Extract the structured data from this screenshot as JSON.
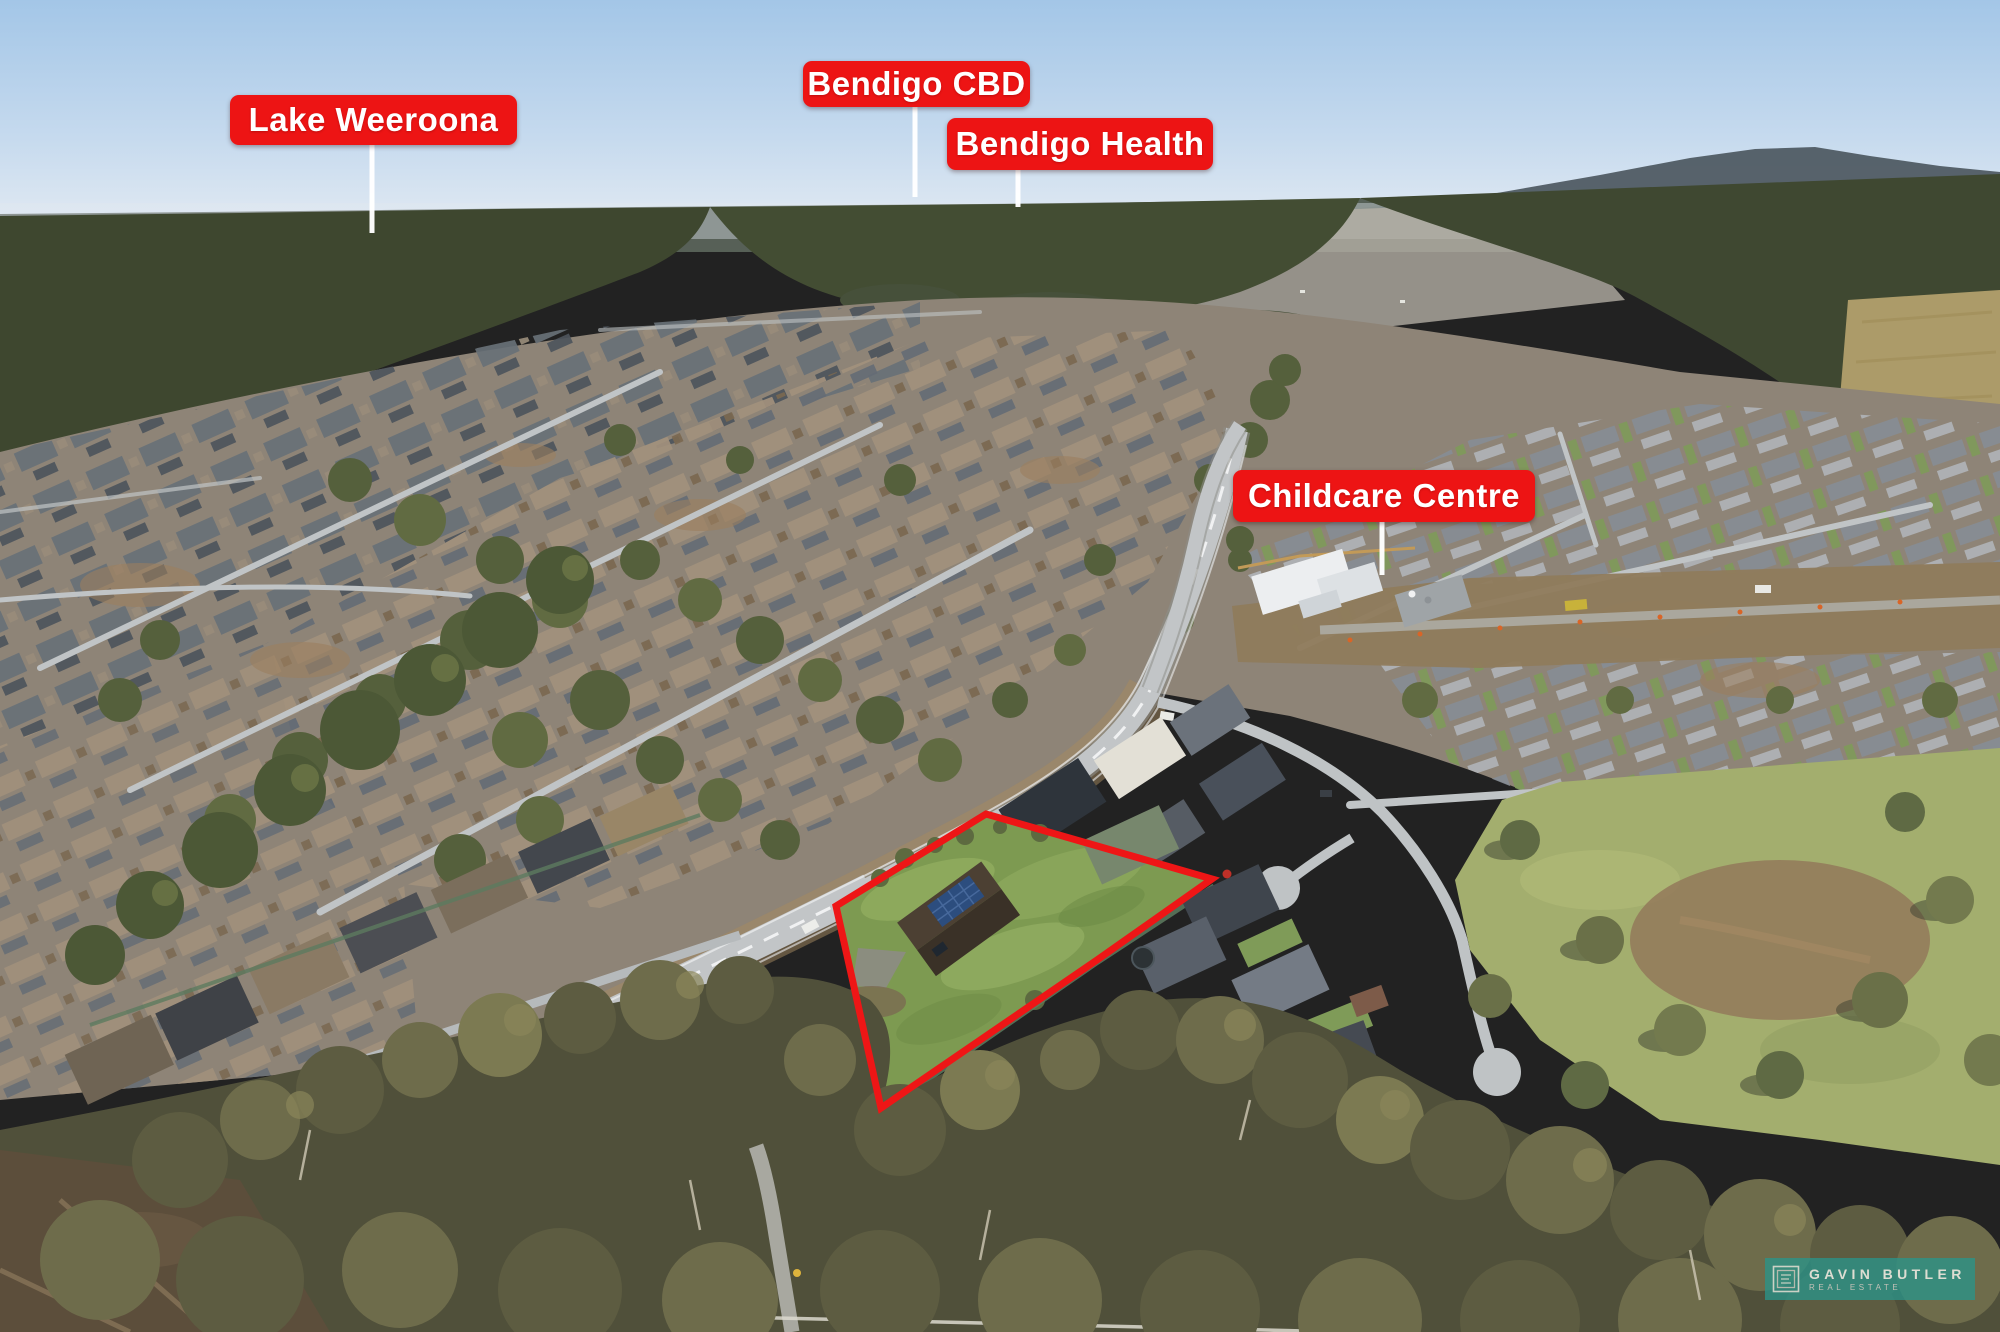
{
  "overlay": {
    "label_bg": "#ed1414",
    "label_fg": "#ffffff",
    "leader_color": "#ffffff",
    "boundary": {
      "color": "#ee1616",
      "path": "M 986 814 L 1212 879 L 1097 960 L 881 1108 L 836 906 Z"
    },
    "labels": [
      {
        "id": "lake-weeroona",
        "text": "Lake Weeroona",
        "leader_path": "M 372 145 L 372 233"
      },
      {
        "id": "bendigo-cbd",
        "text": "Bendigo CBD",
        "leader_path": "M 915 105 L 915 197"
      },
      {
        "id": "bendigo-health",
        "text": "Bendigo Health",
        "leader_path": "M 1018 168 L 1018 207"
      },
      {
        "id": "childcare-centre",
        "text": "Childcare Centre",
        "leader_path": "M 1382 520 L 1382 575"
      }
    ]
  },
  "watermark": {
    "bg": "rgba(42,148,137,0.78)",
    "line1": "GAVIN BUTLER",
    "line2": "REAL ESTATE",
    "logo": "gb-monogram-icon"
  }
}
